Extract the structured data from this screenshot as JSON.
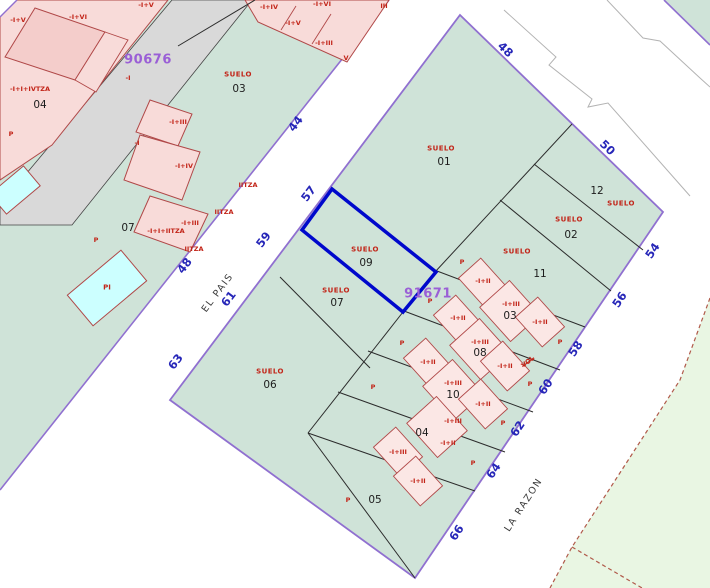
{
  "colors": {
    "parcel_green": "#cfe3d8",
    "pink_fill": "#f8dbd9",
    "pink_inner": "#f4cdcb",
    "pink_light": "#fbe7e5",
    "outline_red": "#b04848",
    "street_purple": "#9070d0",
    "highlight_blue": "#0008cc",
    "number_blue": "#2626b8",
    "label_red": "#c22418",
    "id_purple": "#9a5fd6",
    "gray_strip": "#d9d9d9",
    "light_green": "#e9f6e3",
    "dashed_brown": "#b05a4a",
    "line_black": "#2b2b2b",
    "gray_line": "#b3b3b3",
    "pool_cyan": "#ccffff"
  },
  "map": {
    "sheet_ids": [
      {
        "t": "90676",
        "x": 148,
        "y": 60
      },
      {
        "t": "91671",
        "x": 428,
        "y": 294
      }
    ],
    "street_names": [
      {
        "t": "EL PAIS",
        "x": 218,
        "y": 293,
        "r": -53
      },
      {
        "t": "LA RAZON",
        "x": 524,
        "y": 505,
        "r": -57
      }
    ],
    "street_numbers": [
      {
        "t": "48",
        "x": 505,
        "y": 50,
        "r": 44
      },
      {
        "t": "50",
        "x": 607,
        "y": 148,
        "r": 44
      },
      {
        "t": "54",
        "x": 653,
        "y": 251,
        "r": -56
      },
      {
        "t": "56",
        "x": 620,
        "y": 300,
        "r": -56
      },
      {
        "t": "58",
        "x": 576,
        "y": 349,
        "r": -56
      },
      {
        "t": "60",
        "x": 546,
        "y": 387,
        "r": -56
      },
      {
        "t": "62",
        "x": 518,
        "y": 429,
        "r": -56
      },
      {
        "t": "64",
        "x": 494,
        "y": 471,
        "r": -56
      },
      {
        "t": "66",
        "x": 457,
        "y": 533,
        "r": -56
      },
      {
        "t": "57",
        "x": 309,
        "y": 194,
        "r": -53
      },
      {
        "t": "59",
        "x": 264,
        "y": 240,
        "r": -53
      },
      {
        "t": "61",
        "x": 229,
        "y": 299,
        "r": -53
      },
      {
        "t": "63",
        "x": 176,
        "y": 362,
        "r": -53
      },
      {
        "t": "48",
        "x": 185,
        "y": 266,
        "r": -53
      },
      {
        "t": "44",
        "x": 296,
        "y": 124,
        "r": -53
      }
    ],
    "suelo_labels": [
      {
        "t": "SUELO",
        "x": 441,
        "y": 149
      },
      {
        "t": "SUELO",
        "x": 238,
        "y": 75
      },
      {
        "t": "SUELO",
        "x": 621,
        "y": 204
      },
      {
        "t": "SUELO",
        "x": 569,
        "y": 220
      },
      {
        "t": "SUELO",
        "x": 517,
        "y": 252
      },
      {
        "t": "SUELO",
        "x": 365,
        "y": 250
      },
      {
        "t": "SUELO",
        "x": 336,
        "y": 291
      },
      {
        "t": "SUELO",
        "x": 270,
        "y": 372
      }
    ],
    "parcel_numbers": [
      {
        "t": "01",
        "x": 444,
        "y": 162
      },
      {
        "t": "03",
        "x": 239,
        "y": 89
      },
      {
        "t": "12",
        "x": 597,
        "y": 191
      },
      {
        "t": "02",
        "x": 571,
        "y": 235
      },
      {
        "t": "11",
        "x": 540,
        "y": 274
      },
      {
        "t": "09",
        "x": 366,
        "y": 263
      },
      {
        "t": "07",
        "x": 337,
        "y": 303
      },
      {
        "t": "06",
        "x": 270,
        "y": 385
      },
      {
        "t": "05",
        "x": 375,
        "y": 500
      },
      {
        "t": "07",
        "x": 128,
        "y": 228
      },
      {
        "t": "04",
        "x": 40,
        "y": 105
      },
      {
        "t": "03",
        "x": 510,
        "y": 316
      },
      {
        "t": "08",
        "x": 480,
        "y": 353
      },
      {
        "t": "10",
        "x": 453,
        "y": 395
      },
      {
        "t": "04",
        "x": 422,
        "y": 433
      }
    ],
    "building_labels": [
      {
        "t": "-I+V",
        "x": 18,
        "y": 20
      },
      {
        "t": "-I+VI",
        "x": 78,
        "y": 17
      },
      {
        "t": "-I+V",
        "x": 146,
        "y": 5
      },
      {
        "t": "-I+IV",
        "x": 269,
        "y": 7
      },
      {
        "t": "-I+VI",
        "x": 322,
        "y": 4
      },
      {
        "t": "-I+V",
        "x": 293,
        "y": 23
      },
      {
        "t": "-I+III",
        "x": 324,
        "y": 43
      },
      {
        "t": "III",
        "x": 384,
        "y": 6
      },
      {
        "t": "V",
        "x": 346,
        "y": 58
      },
      {
        "t": "-I",
        "x": 128,
        "y": 78
      },
      {
        "t": "-I",
        "x": 137,
        "y": 143
      },
      {
        "t": "-I+I+IVTZA",
        "x": 30,
        "y": 89
      },
      {
        "t": "-I+III",
        "x": 178,
        "y": 122
      },
      {
        "t": "-I+IV",
        "x": 184,
        "y": 166
      },
      {
        "t": "-I+III",
        "x": 190,
        "y": 223
      },
      {
        "t": "-I+I+IITZA",
        "x": 166,
        "y": 231
      },
      {
        "t": "IITZA",
        "x": 248,
        "y": 185
      },
      {
        "t": "IITZA",
        "x": 224,
        "y": 212
      },
      {
        "t": "IITZA",
        "x": 194,
        "y": 249
      },
      {
        "t": "-I+II",
        "x": 483,
        "y": 281
      },
      {
        "t": "-I+III",
        "x": 511,
        "y": 304
      },
      {
        "t": "-I+II",
        "x": 540,
        "y": 322
      },
      {
        "t": "-I+II",
        "x": 458,
        "y": 318
      },
      {
        "t": "-I+III",
        "x": 480,
        "y": 342
      },
      {
        "t": "-I+II",
        "x": 505,
        "y": 366
      },
      {
        "t": "-I+III",
        "x": 453,
        "y": 383
      },
      {
        "t": "-I+II",
        "x": 428,
        "y": 362
      },
      {
        "t": "-I+II",
        "x": 483,
        "y": 404
      },
      {
        "t": "-I+III",
        "x": 453,
        "y": 421
      },
      {
        "t": "-I+II",
        "x": 448,
        "y": 443
      },
      {
        "t": "-I+III",
        "x": 398,
        "y": 452
      },
      {
        "t": "-I+II",
        "x": 418,
        "y": 481
      }
    ],
    "p_markers": [
      {
        "t": "P",
        "x": 11,
        "y": 134
      },
      {
        "t": "P",
        "x": 96,
        "y": 240
      },
      {
        "t": "P",
        "x": 462,
        "y": 262
      },
      {
        "t": "P",
        "x": 430,
        "y": 301
      },
      {
        "t": "P",
        "x": 402,
        "y": 343
      },
      {
        "t": "P",
        "x": 560,
        "y": 342
      },
      {
        "t": "P",
        "x": 530,
        "y": 384
      },
      {
        "t": "P",
        "x": 373,
        "y": 387
      },
      {
        "t": "P",
        "x": 503,
        "y": 423
      },
      {
        "t": "P",
        "x": 473,
        "y": 463
      },
      {
        "t": "P",
        "x": 348,
        "y": 500
      }
    ],
    "pool_labels": [
      {
        "t": "PI",
        "x": 107,
        "y": 288
      }
    ],
    "misc_labels": [
      {
        "t": "VOL",
        "x": 528,
        "y": 362,
        "r": -38,
        "strike": 1
      }
    ]
  }
}
